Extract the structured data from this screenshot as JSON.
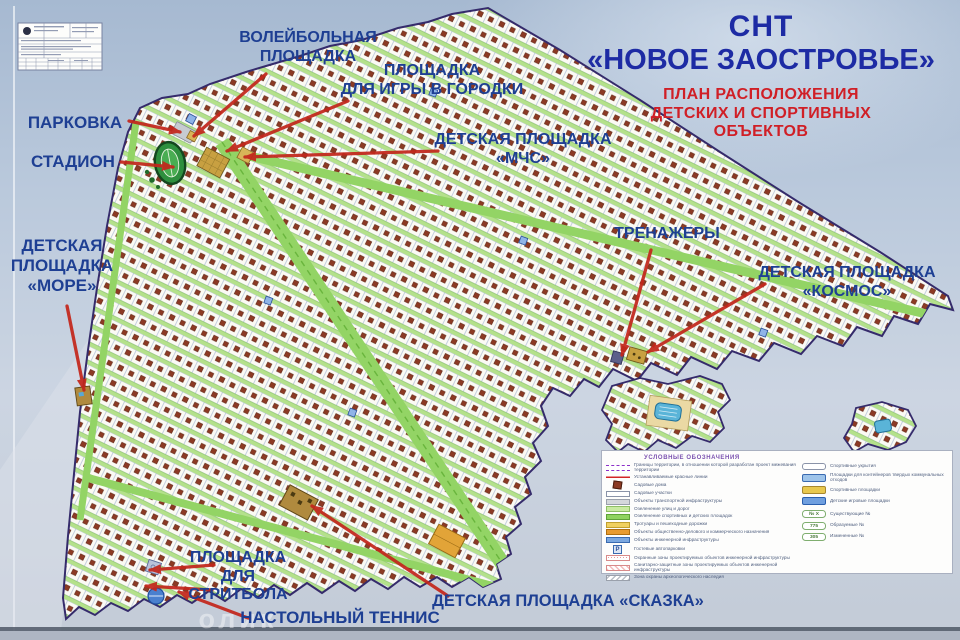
{
  "title": {
    "line1": "СНТ",
    "line2": "«НОВОЕ ЗАОСТРОВЬЕ»",
    "subtitle_lines": [
      "ПЛАН РАСПОЛОЖЕНИЯ",
      "ДЕТСКИХ И СПОРТИВНЫХ",
      "ОБЪЕКТОВ"
    ]
  },
  "map_labels": [
    {
      "id": "volleyball-court",
      "lines": [
        "ВОЛЕЙБОЛЬНАЯ",
        "ПЛОЩАДКА"
      ],
      "x": 308,
      "y": 29,
      "size": 16
    },
    {
      "id": "gorodki-court",
      "lines": [
        "ПЛОЩАДКА",
        "ДЛЯ ИГРЫ В ГОРОДКИ"
      ],
      "x": 432,
      "y": 62,
      "size": 16
    },
    {
      "id": "parking",
      "lines": [
        "ПАРКОВКА"
      ],
      "x": 75,
      "y": 113,
      "size": 17
    },
    {
      "id": "stadium",
      "lines": [
        "СТАДИОН"
      ],
      "x": 73,
      "y": 152,
      "size": 17
    },
    {
      "id": "playground-mchs",
      "lines": [
        "ДЕТСКАЯ ПЛОЩАДКА",
        "«МЧС»"
      ],
      "x": 523,
      "y": 131,
      "size": 16
    },
    {
      "id": "playground-more",
      "lines": [
        "ДЕТСКАЯ",
        "ПЛОЩАДКА",
        "«МОРЕ»"
      ],
      "x": 62,
      "y": 236,
      "size": 17
    },
    {
      "id": "trenazhery",
      "lines": [
        "ТРЕНАЖЕРЫ"
      ],
      "x": 667,
      "y": 225,
      "size": 16
    },
    {
      "id": "playground-kosmos",
      "lines": [
        "ДЕТСКАЯ ПЛОЩАДКА",
        "«КОСМОС»"
      ],
      "x": 847,
      "y": 264,
      "size": 16
    },
    {
      "id": "streetball-court",
      "lines": [
        "ПЛОЩАДКА",
        "ДЛЯ",
        "СТРИТБОЛА"
      ],
      "x": 238,
      "y": 549,
      "size": 16
    },
    {
      "id": "table-tennis",
      "lines": [
        "НАСТОЛЬНЫЙ ТЕННИС"
      ],
      "x": 340,
      "y": 608,
      "size": 17
    },
    {
      "id": "playground-skazka",
      "lines": [
        "ДЕТСКАЯ ПЛОЩАДКА «СКАЗКА»"
      ],
      "x": 568,
      "y": 592,
      "size": 16.5
    }
  ],
  "arrows": [
    {
      "id": "volleyball",
      "x1": 266,
      "y1": 74,
      "x2": 194,
      "y2": 136
    },
    {
      "id": "gorodki",
      "x1": 348,
      "y1": 101,
      "x2": 227,
      "y2": 151
    },
    {
      "id": "parking",
      "x1": 129,
      "y1": 121,
      "x2": 180,
      "y2": 132
    },
    {
      "id": "stadium",
      "x1": 121,
      "y1": 162,
      "x2": 173,
      "y2": 167
    },
    {
      "id": "mchs",
      "x1": 438,
      "y1": 151,
      "x2": 245,
      "y2": 157
    },
    {
      "id": "more",
      "x1": 67,
      "y1": 306,
      "x2": 84,
      "y2": 390
    },
    {
      "id": "trenazhery",
      "x1": 651,
      "y1": 250,
      "x2": 622,
      "y2": 355
    },
    {
      "id": "kosmos",
      "x1": 765,
      "y1": 284,
      "x2": 648,
      "y2": 352
    },
    {
      "id": "streetball-1",
      "x1": 214,
      "y1": 565,
      "x2": 150,
      "y2": 570
    },
    {
      "id": "streetball-2",
      "x1": 212,
      "y1": 590,
      "x2": 146,
      "y2": 586
    },
    {
      "id": "tennis",
      "x1": 248,
      "y1": 618,
      "x2": 179,
      "y2": 592
    },
    {
      "id": "skazka",
      "x1": 448,
      "y1": 596,
      "x2": 312,
      "y2": 506
    }
  ],
  "legend": {
    "title": "УСЛОВНЫЕ ОБОЗНАЧЕНИЯ",
    "left": [
      {
        "swatch": "sw-dashed-purple",
        "text": "Границы территории, в отношении которой разработан проект межевания территории"
      },
      {
        "swatch": "sw-red-line",
        "text": "Устанавливаемые красные линии"
      },
      {
        "swatch": "sw-house",
        "text": "Садовые дома"
      },
      {
        "swatch": "sw-white",
        "text": "Садовые участки"
      },
      {
        "swatch": "sw-gray",
        "text": "Объекты транспортной инфраструктуры"
      },
      {
        "swatch": "sw-lightgreen",
        "text": "Озеленение улиц и дорог"
      },
      {
        "swatch": "sw-green",
        "text": "Озеленение спортивных и детских площадок"
      },
      {
        "swatch": "sw-yellow",
        "text": "Тротуары и пешеходные дорожки"
      },
      {
        "swatch": "sw-orange",
        "text": "Объекты общественно-делового и коммерческого назначения"
      },
      {
        "swatch": "sw-blue",
        "text": "Объекты инженерной инфраструктуры"
      },
      {
        "swatch": "sw-parking",
        "icon": "P",
        "text": "Гостевые автопарковки"
      },
      {
        "swatch": "sw-dots-pink",
        "text": "Охранные зоны проектируемых объектов инженерной инфраструктуры"
      },
      {
        "swatch": "sw-hatch-pink",
        "text": "Санитарно-защитные зоны проектируемых объектов инженерной инфраструктуры"
      },
      {
        "swatch": "sw-hatch-gray",
        "text": "Зона охраны археологического наследия"
      }
    ],
    "right": [
      {
        "swatch": "sw-pill-white",
        "text": "Спортивные укрытия"
      },
      {
        "swatch": "sw-bin-blue",
        "text": "Площадки для контейнеров твердых коммунальных отходов"
      },
      {
        "swatch": "sw-sport-yellow",
        "text": "Спортивные площадки"
      },
      {
        "swatch": "sw-play-blue",
        "text": "Детские игровые площадки"
      }
    ],
    "numbered": [
      {
        "num": "№ Х",
        "text": "Существующие №"
      },
      {
        "num": "775",
        "text": "Образуемые №"
      },
      {
        "num": "305",
        "text": "Измененные №"
      }
    ]
  },
  "watermark": "олик",
  "colors": {
    "label_navy": "#1e3f93",
    "title_navy": "#1d2ba4",
    "subtitle_red": "#d01f26",
    "arrow_red": "#c3271c",
    "boundary_purple": "#352b6b",
    "road_green": "#93d465",
    "street_green": "#b4e18b",
    "stadium_green": "#2e8f3e",
    "sand_tan": "#c8a041",
    "pool_blue": "#5ab4d8",
    "house_brown": "#8c3a24"
  }
}
